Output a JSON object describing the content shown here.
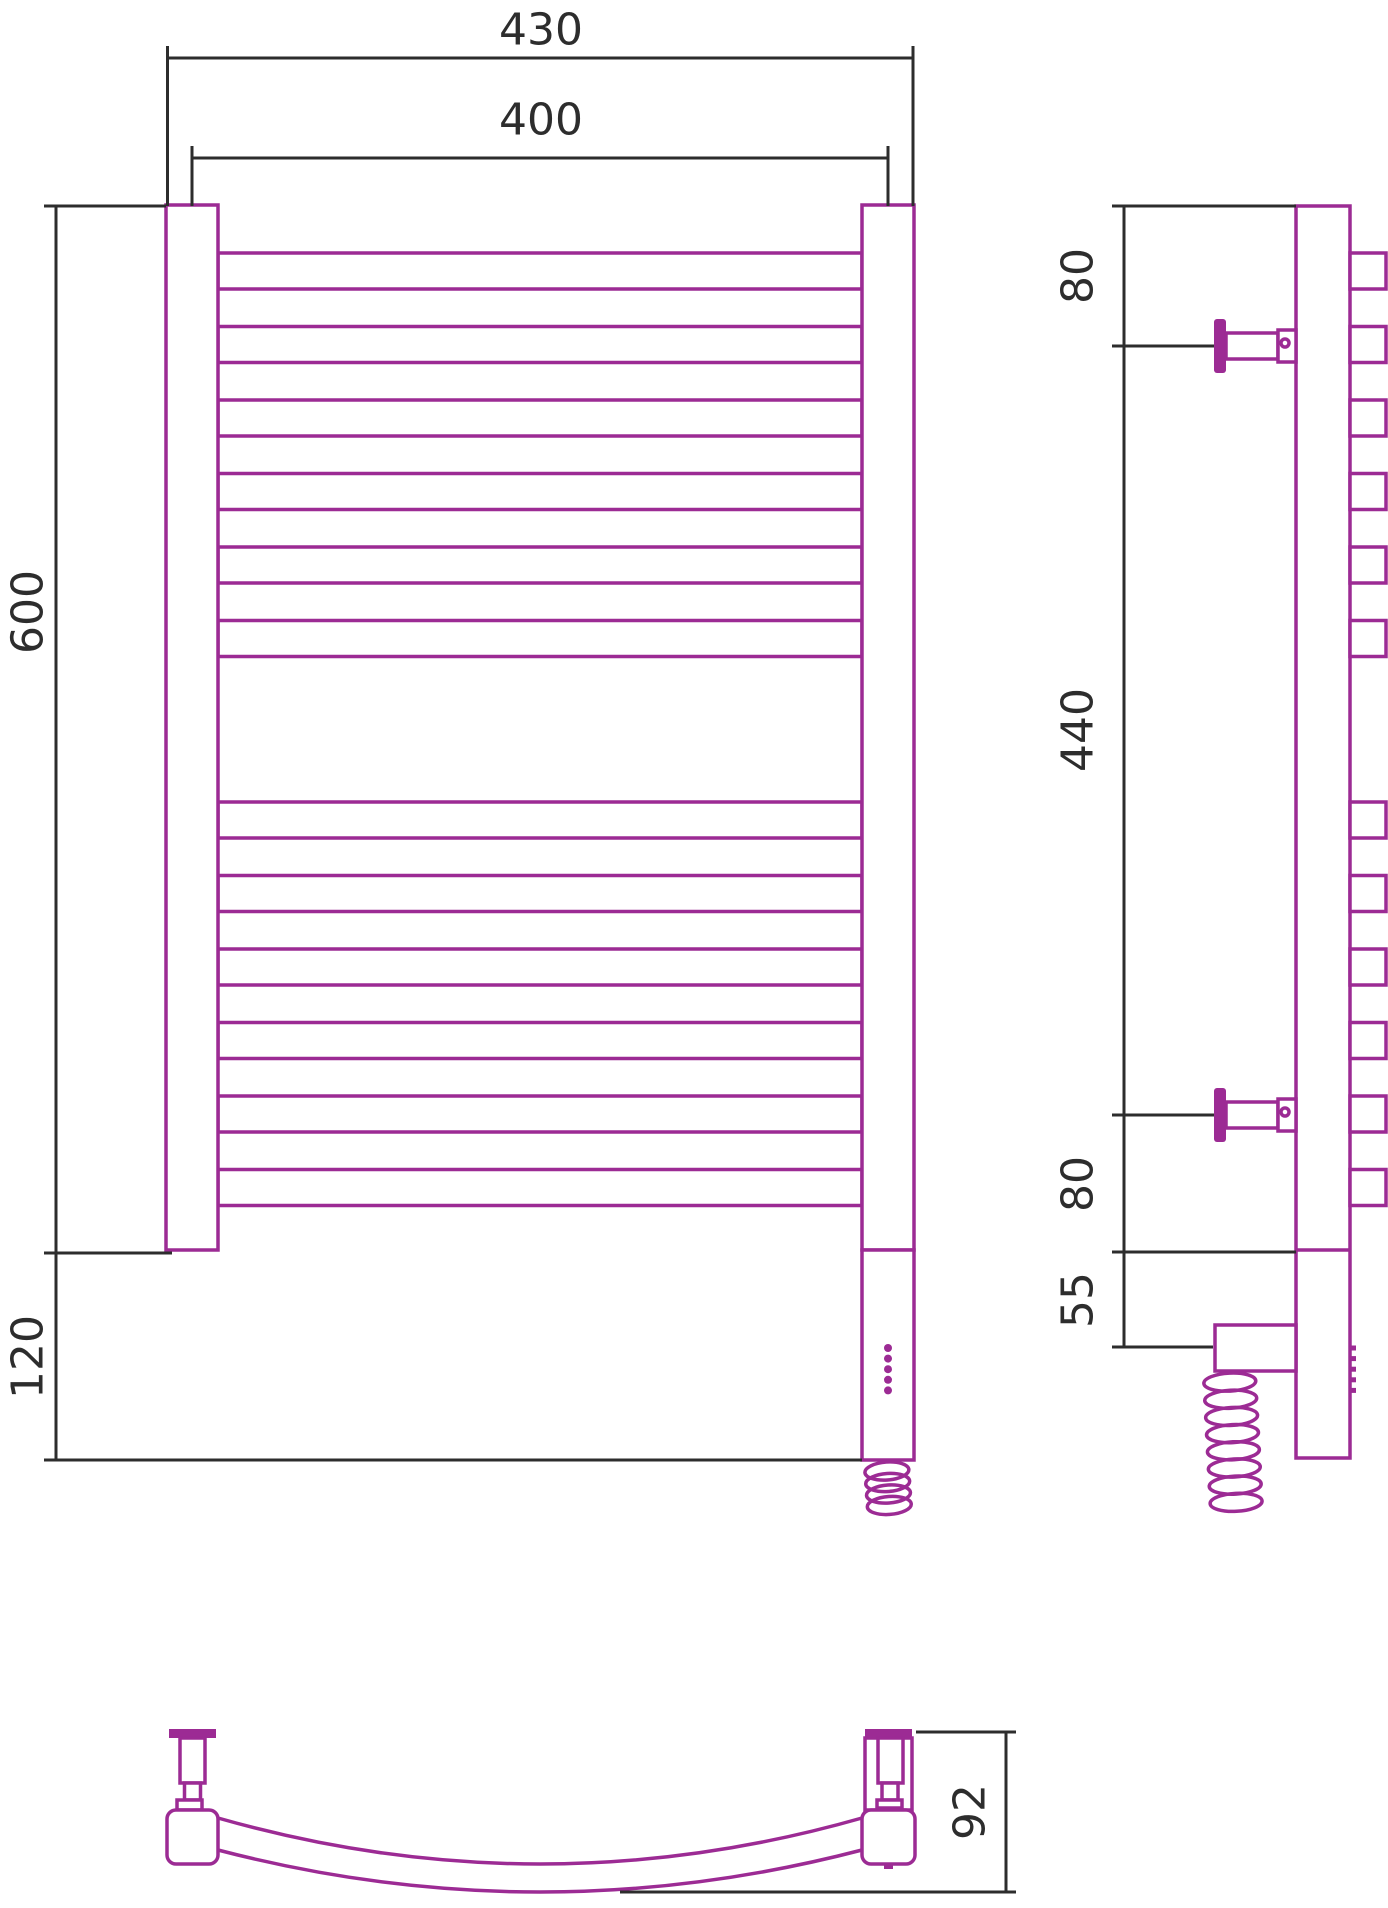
{
  "drawing": {
    "front": {
      "outer_width": "430",
      "inner_width": "400",
      "body_height": "600",
      "lower_height": "120"
    },
    "side": {
      "top_to_bracket": "80",
      "bracket_span": "440",
      "bracket_to_bottom": "80",
      "unit_drop": "55"
    },
    "top": {
      "depth": "92"
    },
    "structure": {
      "tube_groups": [
        6,
        6
      ],
      "tube_group_start_y": [
        253,
        802
      ],
      "tube_step": 73.5,
      "tube_height": 36,
      "indicator_dots": 5,
      "front_coil_loops": 4,
      "side_coil_loops": 8,
      "bracket_centers_y": [
        346,
        1115
      ]
    },
    "colors": {
      "product": "#9c2b94",
      "dimension": "#2d2d2d"
    }
  }
}
